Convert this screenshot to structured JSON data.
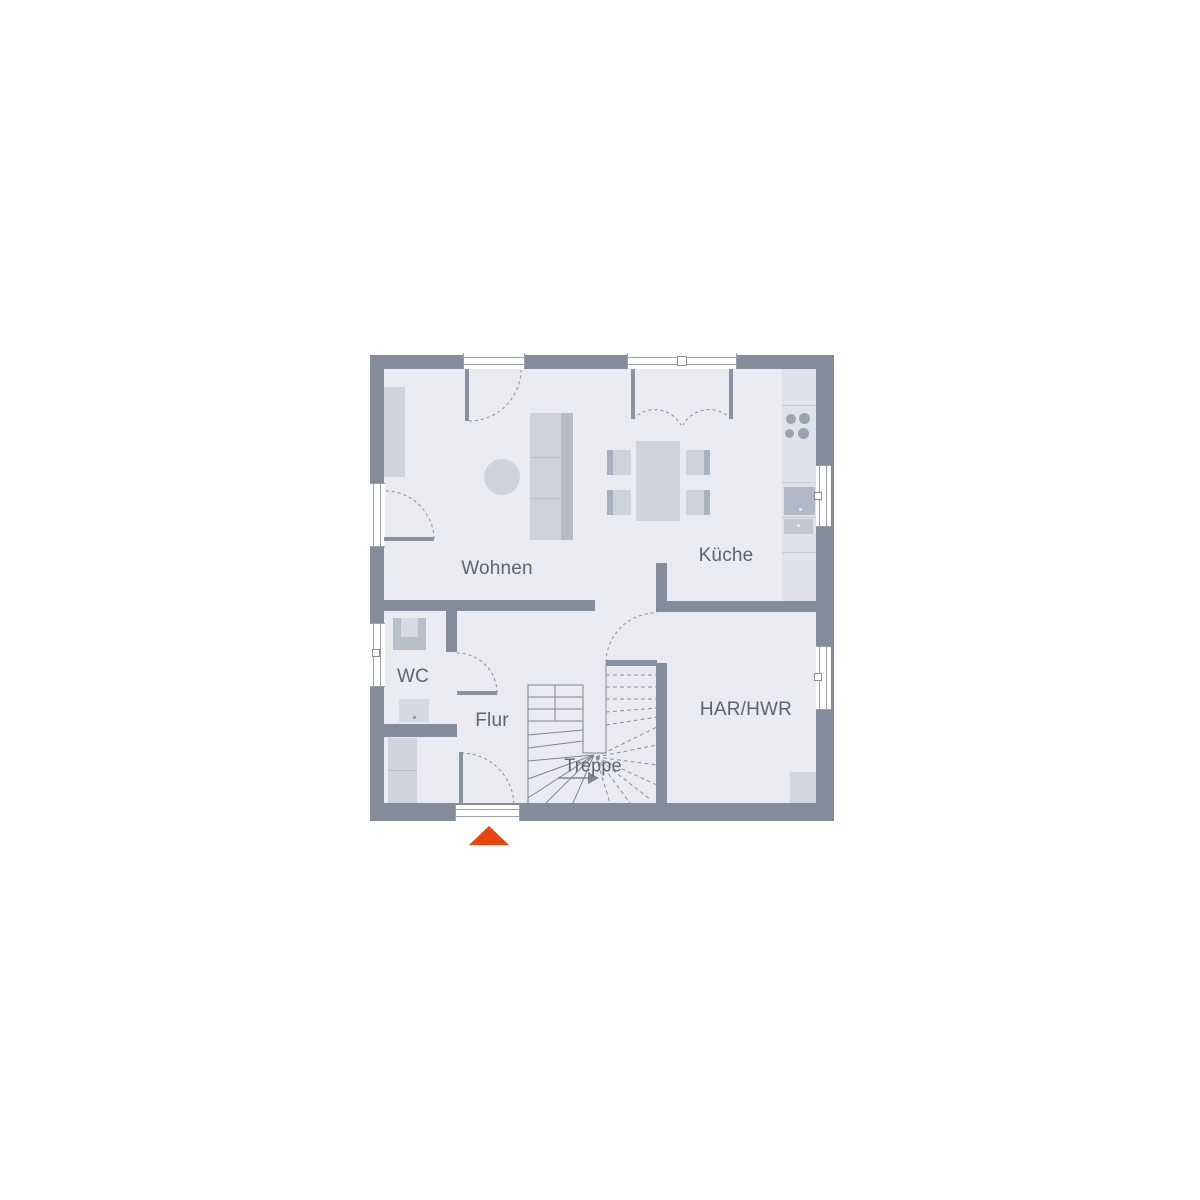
{
  "rooms": {
    "wohnen": "Wohnen",
    "kueche": "Küche",
    "wc": "WC",
    "flur": "Flur",
    "treppe": "Treppe",
    "har_hwr": "HAR/HWR"
  },
  "icons": {
    "entrance_marker": "entrance-arrow-triangle"
  },
  "colors": {
    "wall": "#848b9a",
    "floor": "#e9ebf0",
    "furniture_light": "#d0d4dd",
    "furniture_mid": "#c3c8d2",
    "furniture_dark": "#b2b8c4",
    "kitchen_counter": "#dfe2e9",
    "door_line": "#8a92a1",
    "stair_line": "#7d8593",
    "label_text": "#5d6471",
    "window": "#ffffff",
    "accent": "#e8440c"
  }
}
